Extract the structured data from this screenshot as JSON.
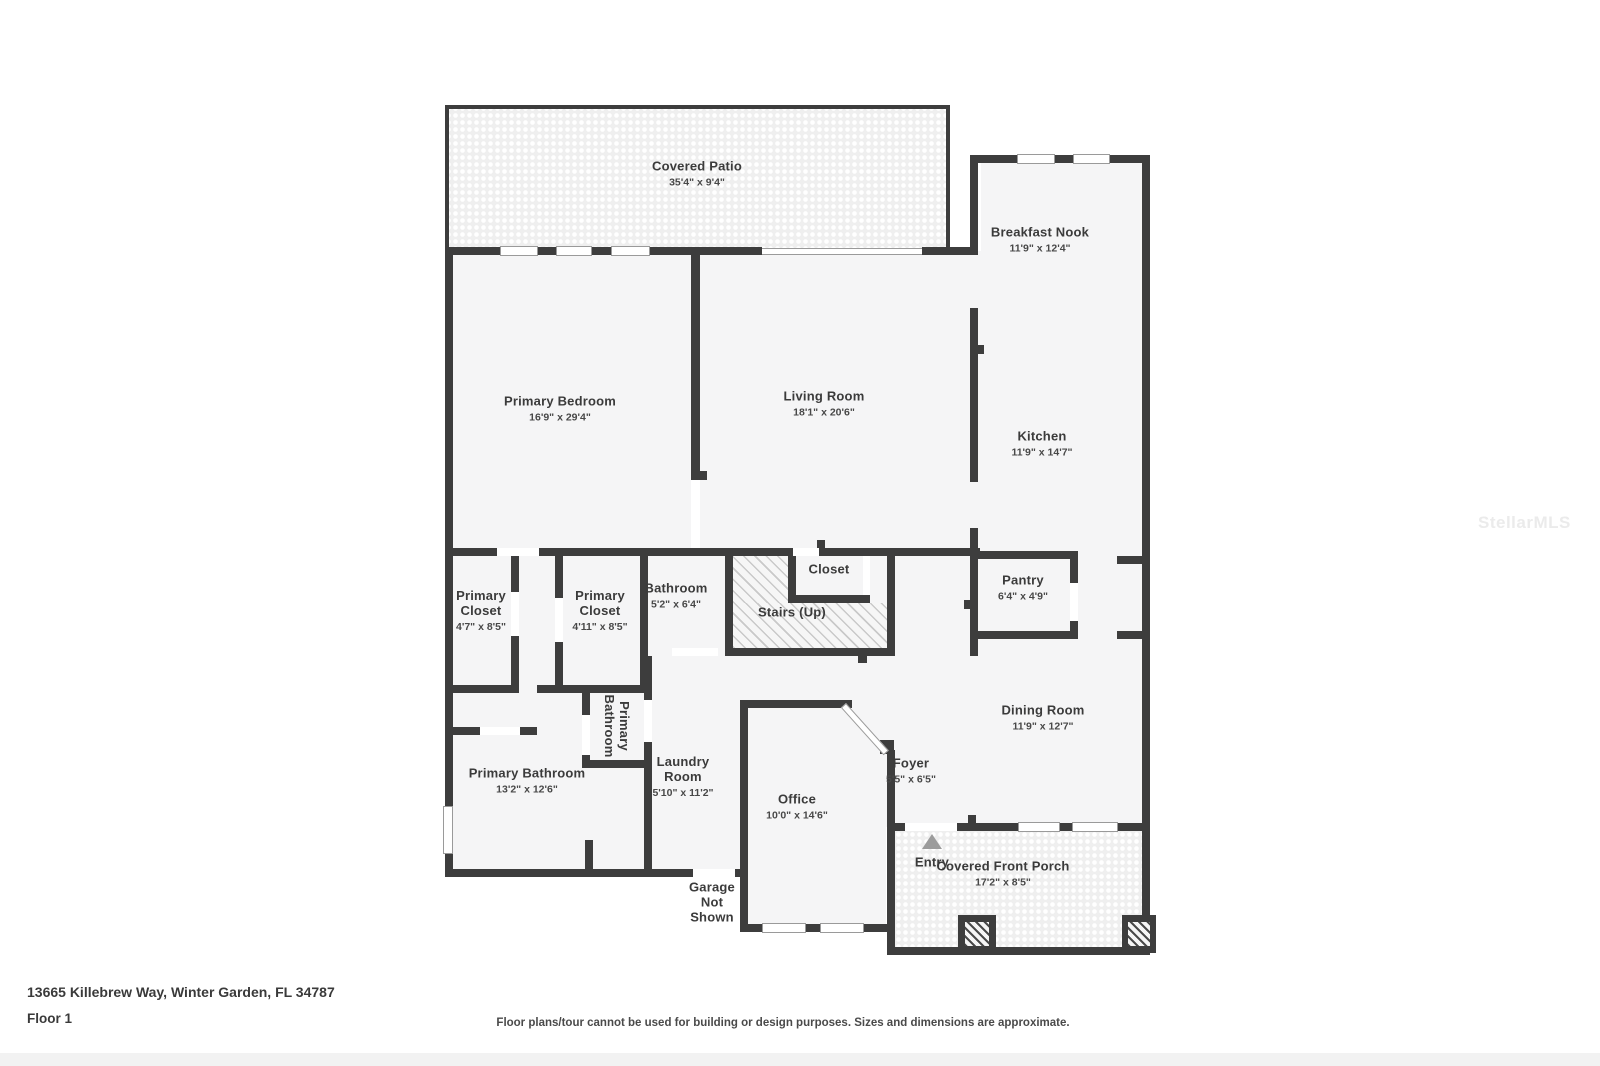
{
  "floor_plan": {
    "address": "13665 Killebrew Way, Winter Garden, FL 34787",
    "floor_label": "Floor 1",
    "disclaimer": "Floor plans/tour cannot be used for building or design purposes. Sizes and dimensions are approximate.",
    "watermark": "StellarMLS",
    "entry_label": "Entry",
    "garage_note": "Garage Not Shown",
    "colors": {
      "wall": "#3d3d3d",
      "room_fill": "#f5f5f6",
      "texture_background": "#efefef",
      "entry_arrow": "#9c9c9c"
    },
    "rooms": {
      "covered_patio": {
        "name": "Covered Patio",
        "dims": "35'4\" x 9'4\""
      },
      "breakfast_nook": {
        "name": "Breakfast Nook",
        "dims": "11'9\" x 12'4\""
      },
      "primary_bedroom": {
        "name": "Primary Bedroom",
        "dims": "16'9\" x 29'4\""
      },
      "living_room": {
        "name": "Living Room",
        "dims": "18'1\" x 20'6\""
      },
      "kitchen": {
        "name": "Kitchen",
        "dims": "11'9\" x 14'7\""
      },
      "primary_closet_1": {
        "name": "Primary Closet",
        "dims": "4'7\" x 8'5\""
      },
      "primary_closet_2": {
        "name": "Primary Closet",
        "dims": "4'11\" x 8'5\""
      },
      "bathroom": {
        "name": "Bathroom",
        "dims": "5'2\" x 6'4\""
      },
      "closet": {
        "name": "Closet"
      },
      "stairs": {
        "name": "Stairs (Up)"
      },
      "pantry": {
        "name": "Pantry",
        "dims": "6'4\" x 4'9\""
      },
      "primary_bathroom": {
        "name": "Primary Bathroom",
        "dims": "13'2\" x 12'6\""
      },
      "primary_bathroom_small": {
        "name": "Primary Bathroom"
      },
      "laundry_room": {
        "name": "Laundry Room",
        "dims": "5'10\" x 11'2\""
      },
      "office": {
        "name": "Office",
        "dims": "10'0\" x 14'6\""
      },
      "foyer": {
        "name": "Foyer",
        "dims": "5'5\" x 6'5\""
      },
      "dining_room": {
        "name": "Dining Room",
        "dims": "11'9\" x 12'7\""
      },
      "covered_front_porch": {
        "name": "Covered Front Porch",
        "dims": "17'2\" x 8'5\""
      }
    }
  }
}
